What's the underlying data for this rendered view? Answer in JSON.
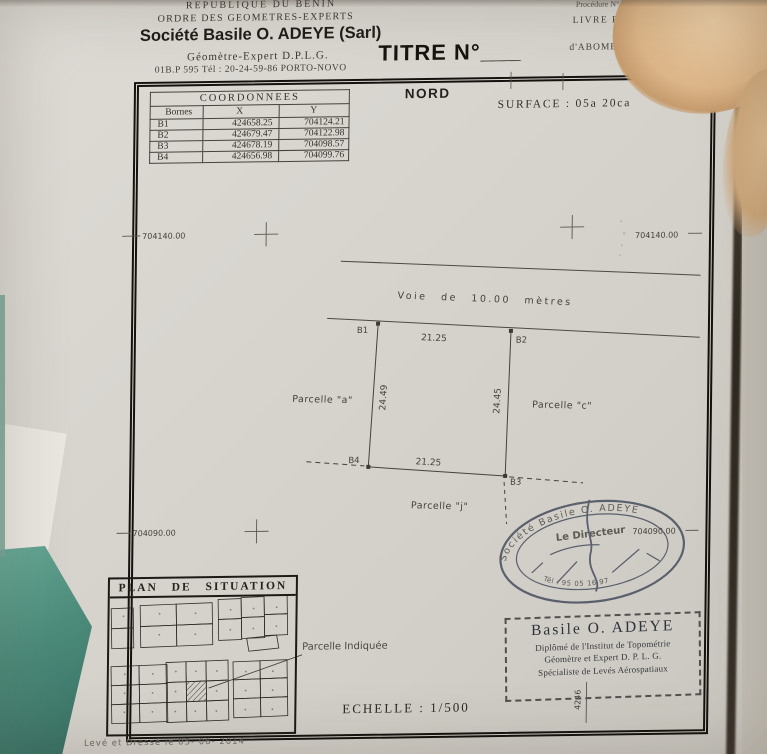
{
  "colors": {
    "paper": "#d8d5cf",
    "ink": "#34312c",
    "drawing_ink": "#45423c",
    "seal_ink": "#41485a",
    "teal_background": "#4d8c7b",
    "skin_tone": "#dcb588",
    "photo_background": "#c9c5be"
  },
  "header": {
    "country": "REPUBLIQUE DU BENIN",
    "order": "ORDRE DES GEOMETRES-EXPERTS",
    "company": "Société Basile O. ADEYE (Sarl)",
    "expert": "Géomètre-Expert D.P.L.G.",
    "contact": "01B.P 595 Tél : 20-24-59-86 PORTO-NOVO",
    "title": "TITRE N°",
    "title_blank": "____",
    "procedure": "Procédure N°....",
    "livre": "LIVRE FONCIER",
    "place": "d'ABOMEY-CALAVI"
  },
  "coordinates": {
    "title": "COORDONNEES",
    "col_bornes": "Bornes",
    "col_x": "X",
    "col_y": "Y",
    "rows": [
      {
        "borne": "B1",
        "x": "424658.25",
        "y": "704124.21"
      },
      {
        "borne": "B2",
        "x": "424679.47",
        "y": "704122.98"
      },
      {
        "borne": "B3",
        "x": "424678.19",
        "y": "704098.57"
      },
      {
        "borne": "B4",
        "x": "424656.98",
        "y": "704099.76"
      }
    ]
  },
  "plan": {
    "north": "NORD",
    "surface": "SURFACE : 05a 20ca",
    "grid_top_left": "704140.00",
    "grid_top_right": "704140.00",
    "grid_bottom_left": "704090.00",
    "grid_bottom_right": "704090.00",
    "grid_vertical": "4246",
    "road": "Voie de 10.00 mètres",
    "b1": "B1",
    "b2": "B2",
    "b3": "B3",
    "b4": "B4",
    "dim_top": "21.25",
    "dim_bottom": "21.25",
    "dim_left": "24.49",
    "dim_right": "24.45",
    "parcelle_a": "Parcelle \"a\"",
    "parcelle_c": "Parcelle \"c\"",
    "parcelle_j": "Parcelle \"j\""
  },
  "situation": {
    "title": "PLAN DE SITUATION",
    "annotation": "Parcelle Indiquée"
  },
  "seal": {
    "arc": "Société Basile O. ADEYE",
    "director": "Le Directeur",
    "phone": "Tél : 95 05 16 97"
  },
  "stamp": {
    "name": "Basile O. ADEYE",
    "line1": "Diplômé de l'Institut de Topométrie",
    "line2": "Géomètre et Expert D. P. L. G.",
    "line3": "Spécialiste de Levés Aérospatiaux"
  },
  "scale": "ECHELLE : 1/500",
  "footer": "Levé et Dressé le 05- 06- 2014"
}
